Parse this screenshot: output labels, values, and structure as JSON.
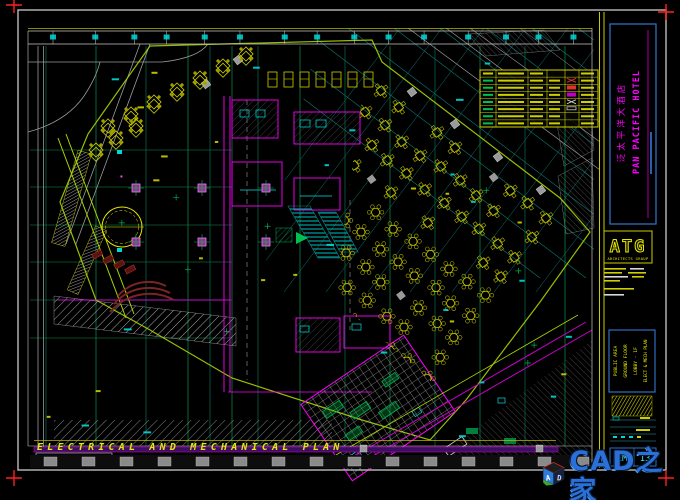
{
  "colors": {
    "background": "#000000",
    "frame": "#c8c8c8",
    "grid_green": "#0e8f4e",
    "grid_teal": "#0c7a72",
    "wall_magenta": "#ff00ff",
    "furniture_yellow": "#cfcf00",
    "outline_chartreuse": "#aad400",
    "annotation_cyan": "#00d8d8",
    "registration_red": "#ff2020",
    "title_block_blue": "#2e6fc0",
    "watermark_blue": "#2b70d8"
  },
  "title_block": {
    "hotel_name_cn": "泛太平洋大酒店",
    "hotel_name_en": "PAN PACIFIC HOTEL",
    "logo_text": "ATG",
    "logo_subtext": "ARCHITECTS GROUP",
    "sheet_lines": [
      "PUBLIC AREA",
      "GROUND FLOOR",
      "LOBBY - 1F",
      "ELECT & MECH PLAN"
    ],
    "drawing_no_prefix": "EM",
    "drawing_no": "13"
  },
  "footer": {
    "plan_title": "ELECTRICAL AND MECHANICAL PLAN",
    "scale_label": "SCALE",
    "scale_value": "1/100(A1)  1/200(A3)",
    "elevation_marker": "369"
  },
  "watermark": {
    "logo_letter_a": "A",
    "logo_letter_d": "D",
    "site_name": "CAD之家",
    "site_url": "WWW.CADZJ.COM"
  }
}
